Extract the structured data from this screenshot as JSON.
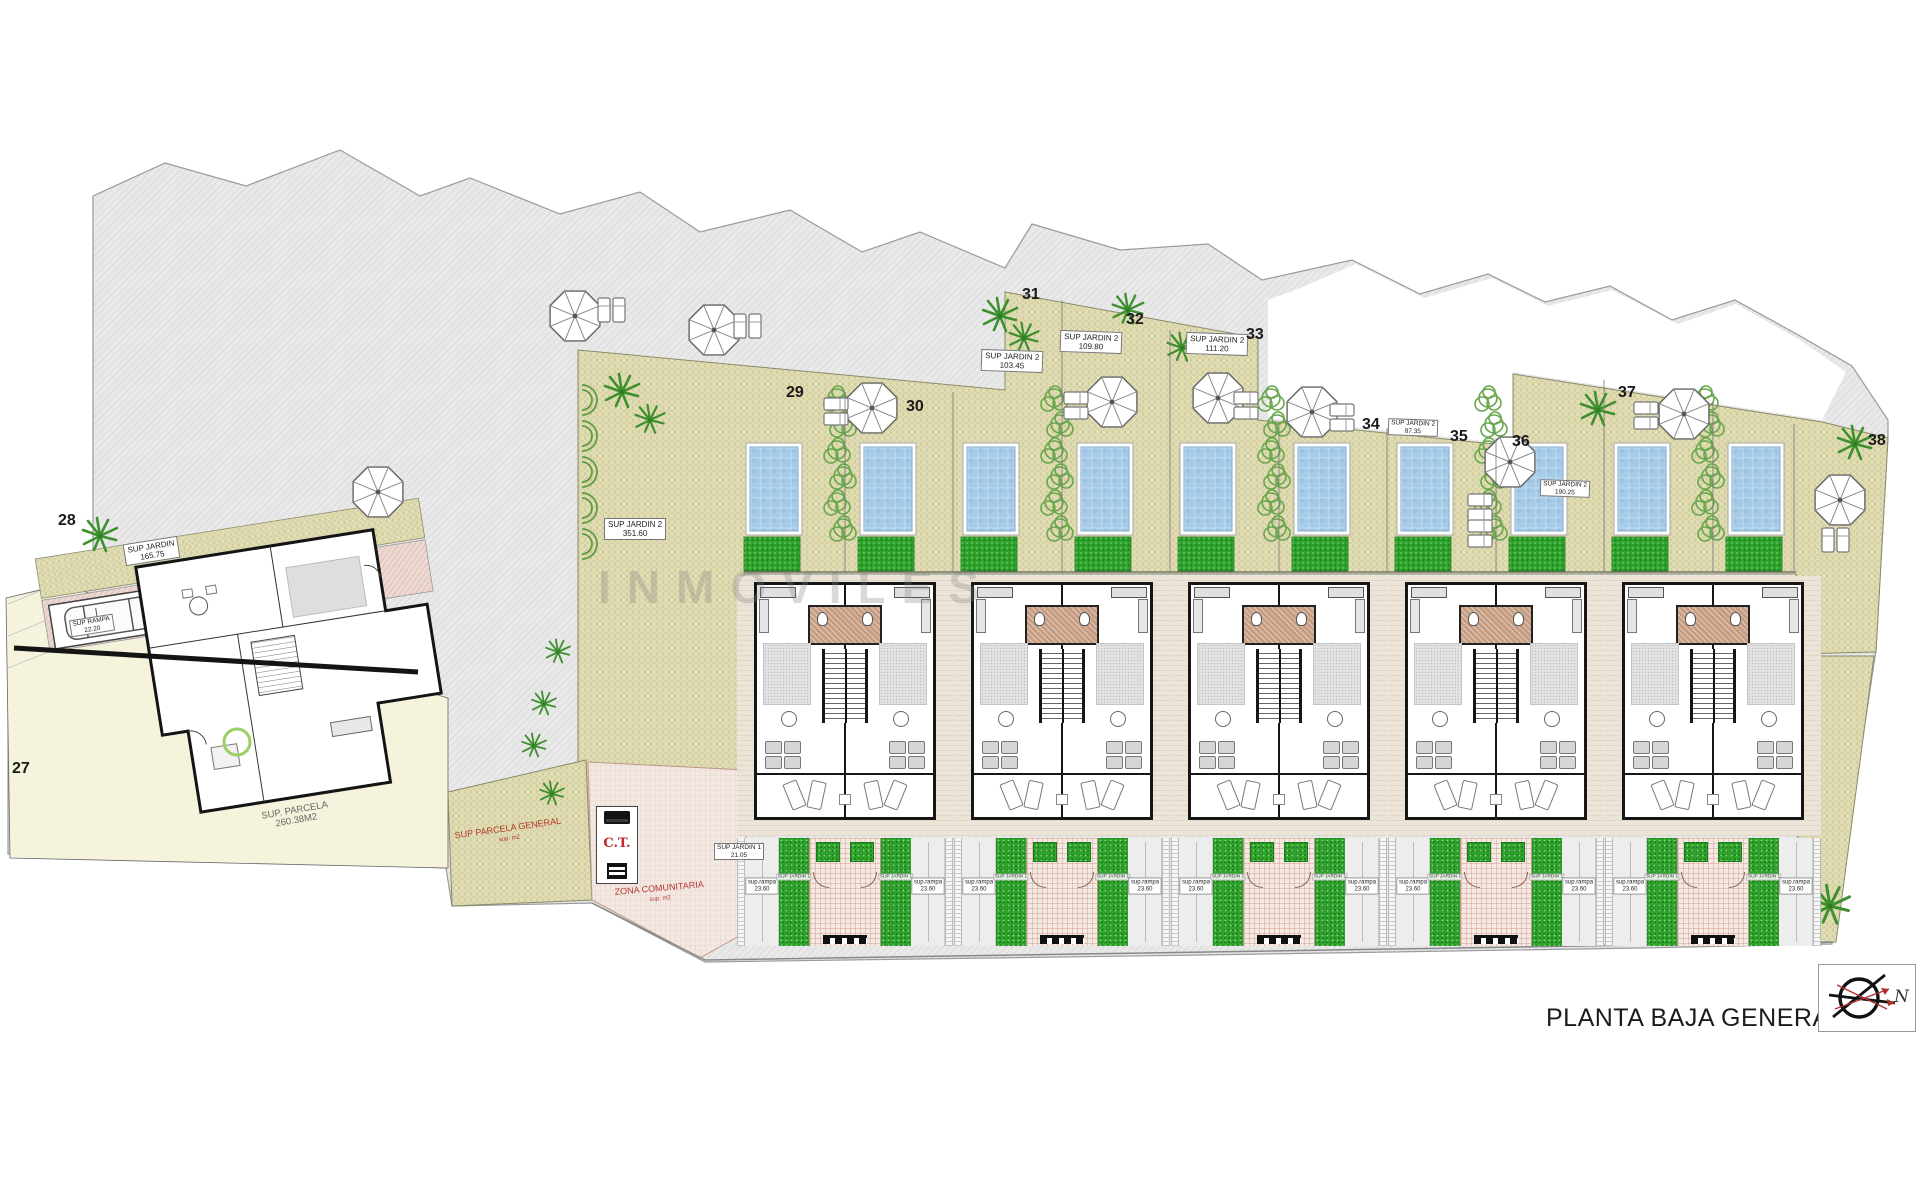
{
  "header": {
    "title": "PLANTA BAJA GENERAL",
    "compass_n": "N"
  },
  "watermark": "INMOVILES",
  "plots": {
    "p27": "27",
    "p28": "28",
    "p29": "29",
    "p30": "30",
    "p31": "31",
    "p32": "32",
    "p33": "33",
    "p34": "34",
    "p35": "35",
    "p36": "36",
    "p37": "37",
    "p38": "38"
  },
  "area_labels": {
    "jardin28": {
      "l1": "SUP JARDIN",
      "l2": "165.75"
    },
    "rampa28": {
      "l1": "SUP RAMPA",
      "l2": "22.20"
    },
    "parcela27": {
      "l1": "SUP. PARCELA",
      "l2": "260.38M2"
    },
    "jardin29": {
      "l1": "SUP JARDIN 2",
      "l2": "351.60"
    },
    "jardin31": {
      "l1": "SUP JARDIN 2",
      "l2": "103.45"
    },
    "jardin32": {
      "l1": "SUP JARDIN 2",
      "l2": "109.80"
    },
    "jardin33": {
      "l1": "SUP JARDIN 2",
      "l2": "111.20"
    },
    "jardin34": {
      "l1": "SUP JARDIN 2",
      "l2": "87.35"
    },
    "jardin38": {
      "l1": "SUP JARDIN 2",
      "l2": "190.25"
    },
    "jardin1_entry": {
      "l1": "SUP JARDIN 1",
      "l2": "21.05"
    },
    "parcela_general": {
      "l1": "SUP PARCELA GENERAL",
      "l2": "sup. m2"
    },
    "zona_comunitaria": {
      "l1": "ZONA COMUNITARIA",
      "l2": "sup. m2"
    },
    "ct": "C.T."
  },
  "building_labels": {
    "rampa_l1": "sup.rampa",
    "rampa_l2": "23.60",
    "jardin1": "SUP JARDIN 1"
  },
  "buildings": [
    {
      "id": "building-1"
    },
    {
      "id": "building-2"
    },
    {
      "id": "building-3"
    },
    {
      "id": "building-4"
    },
    {
      "id": "building-5"
    }
  ],
  "colors": {
    "pool": "#a6cbe8",
    "lawn": "#2ea32b",
    "garden_tan": "#d8d3a2",
    "paving_gray": "#e9e9e9",
    "accent_red": "#b3372e"
  }
}
